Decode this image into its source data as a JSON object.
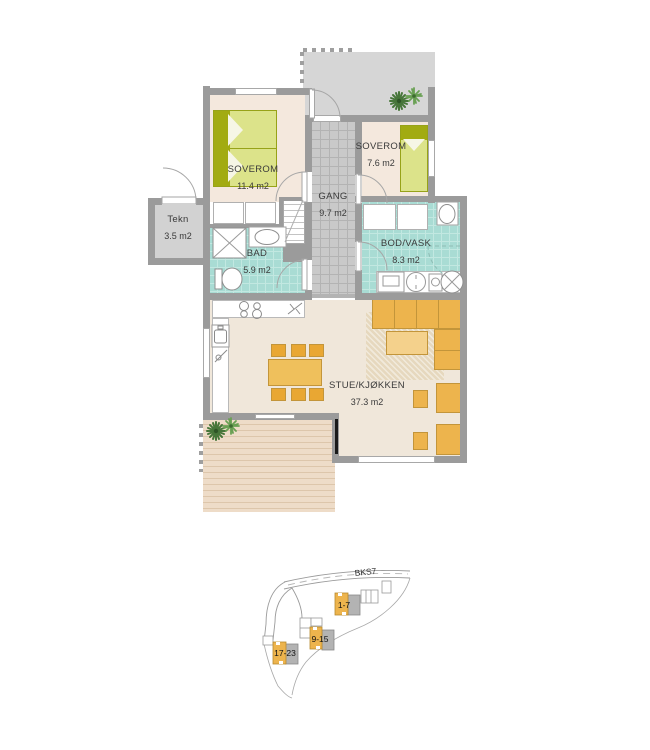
{
  "floor_plan": {
    "rooms": [
      {
        "name": "SOVEROM",
        "area": "11.4 m2"
      },
      {
        "name": "SOVEROM",
        "area": "7.6 m2"
      },
      {
        "name": "GANG",
        "area": "9.7 m2"
      },
      {
        "name": "Tekn",
        "area": "3.5 m2"
      },
      {
        "name": "BAD",
        "area": "5.9 m2"
      },
      {
        "name": "BOD/VASK",
        "area": "8.3 m2"
      },
      {
        "name": "STUE/KJØKKEN",
        "area": "37.3 m2"
      }
    ]
  },
  "site_plan": {
    "road_label": "BKS7",
    "buildings": [
      {
        "label": "1-7"
      },
      {
        "label": "9-15"
      },
      {
        "label": "17-23"
      }
    ]
  },
  "colors": {
    "wall": "#9b9b9b",
    "bedroom_floor": "#f4e8dd",
    "living_floor": "#f0e7da",
    "wet_room_tile": "#a9dcd4",
    "hall_tile": "#c9c9c9",
    "terrace": "#d6d6d6",
    "deck": "#eedcc8",
    "furniture_orange": "#edb44d",
    "bed_green": "#dce38a",
    "bed_green_dark": "#a2ab12",
    "plant_green": "#47763a",
    "site_building_orange": "#edb44d",
    "site_building_gray": "#b3b3b3"
  },
  "icons": {
    "plant-icon": "green starburst",
    "shower-icon": "square with diagonal cross",
    "toilet-icon": "ellipse bowl with cistern",
    "washbasin-icon": "ellipse in rectangle",
    "stove-icon": "four burner circles",
    "dishwasher-icon": "diagonal tick symbol",
    "kitchen-sink-icon": "rounded basin with tap",
    "washing-machine-icon": "square with door panel",
    "dryer-icon": "circle with ticks",
    "laundry-sink-icon": "circle with cross",
    "door-swing-icon": "quarter arc",
    "sliding-door-icon": "black bar"
  }
}
